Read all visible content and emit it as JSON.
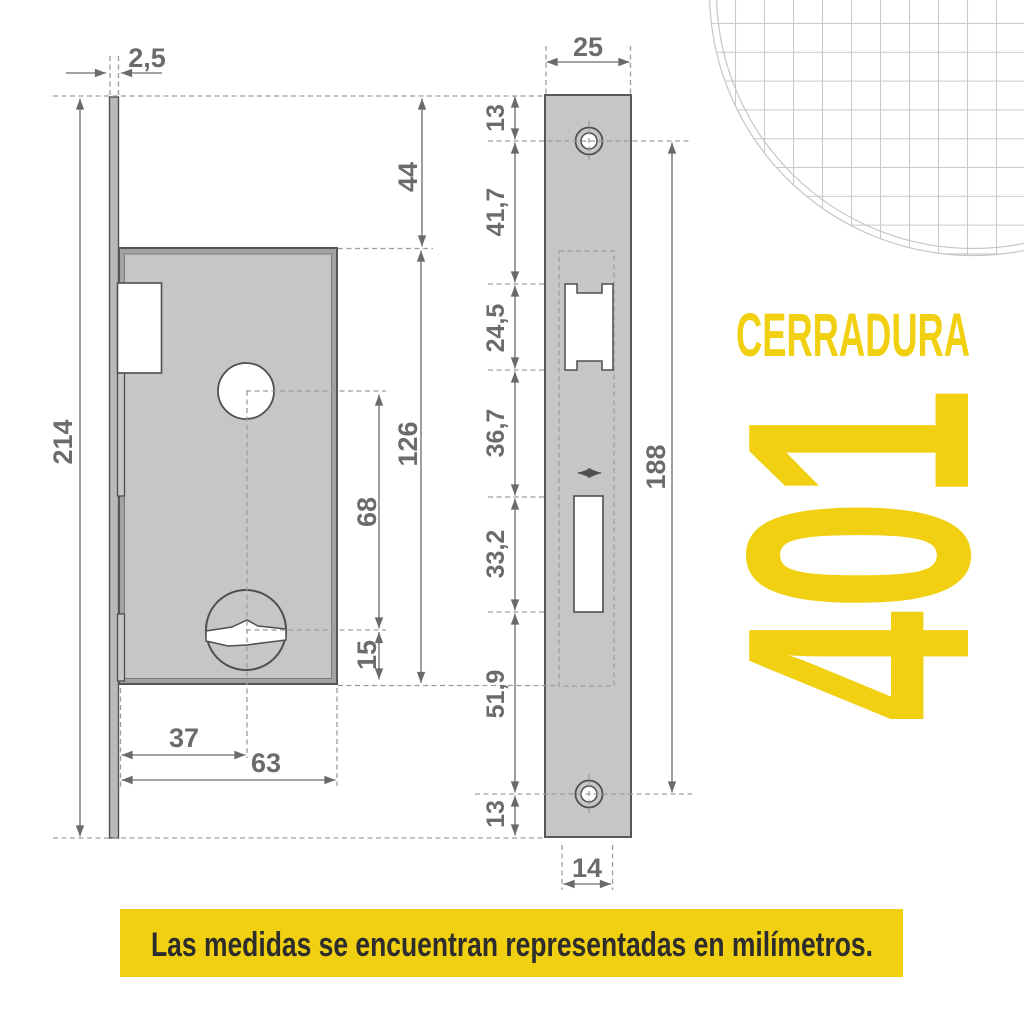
{
  "branding": {
    "series_label": "CERRADURA",
    "model_number": "401",
    "accent_color": "#F1D011"
  },
  "footer": {
    "note": "Las medidas se encuentran representadas en milímetros."
  },
  "side_view": {
    "dims": {
      "overall_height": "214",
      "faceplate_thickness": "2,5",
      "top_to_case": "44",
      "case_height": "126",
      "hub_to_cylinder": "68",
      "cylinder_to_case_bottom": "15",
      "backset": "37",
      "case_depth": "63"
    }
  },
  "front_view": {
    "dims": {
      "faceplate_width": "25",
      "top_to_screw": "13",
      "screw_to_latch": "41,7",
      "latch_cutout_height": "24,5",
      "latch_to_bolt": "36,7",
      "bolt_cutout_height": "33,2",
      "bolt_to_screw": "51,9",
      "screw_to_bottom": "13",
      "screw_spacing": "188",
      "case_width": "14"
    }
  },
  "colors": {
    "accent": "#F1D011",
    "dimension_line": "#6a6a6a",
    "outline": "#4f4f4f",
    "metal_gray": "#c6c6c5",
    "note_text": "#2d2d2d"
  }
}
